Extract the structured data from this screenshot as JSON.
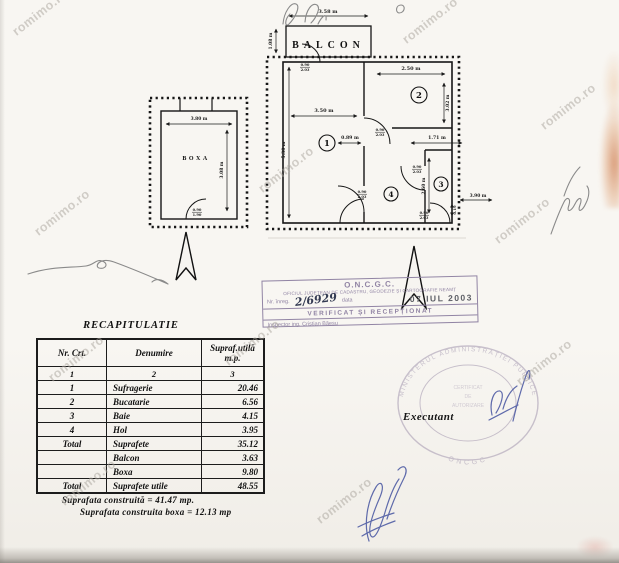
{
  "watermark": {
    "text": "romimo.ro",
    "instances": [
      {
        "x": 14,
        "y": 26,
        "rot": -38
      },
      {
        "x": 404,
        "y": 34,
        "rot": -38
      },
      {
        "x": 542,
        "y": 120,
        "rot": -38
      },
      {
        "x": 36,
        "y": 226,
        "rot": -38
      },
      {
        "x": 260,
        "y": 183,
        "rot": -38
      },
      {
        "x": 496,
        "y": 234,
        "rot": -38
      },
      {
        "x": 50,
        "y": 372,
        "rot": -38
      },
      {
        "x": 226,
        "y": 356,
        "rot": -38
      },
      {
        "x": 518,
        "y": 376,
        "rot": -38
      },
      {
        "x": 62,
        "y": 496,
        "rot": -38
      },
      {
        "x": 318,
        "y": 514,
        "rot": -38
      }
    ]
  },
  "main_plan": {
    "balcony_label": "BALCON",
    "rooms": [
      "1",
      "2",
      "3",
      "4"
    ],
    "dims": {
      "balcony_width": "3.58 m",
      "balcony_depth": "1.08 m",
      "room1_width": "3.50 m",
      "left_height": "5.30 m",
      "seg_a": "0.89 m",
      "seg_b": "1.71 m",
      "room2_width": "2.50 m",
      "room2_height": "3.02 m",
      "bath_height": "2.60 m",
      "right_ext": "3.90 m",
      "right_small": "0.19"
    },
    "door_w": "0.90",
    "door_h": "2.03"
  },
  "boxa_plan": {
    "label": "BOXA",
    "dims": {
      "width": "3.80 m",
      "height": "3.08 m"
    },
    "door_w": "0.90",
    "door_h": "1.90"
  },
  "stamp": {
    "org": "O.N.C.G.C.",
    "office": "OFICIUL JUDEȚEAN DE CADASTRU, GEODEZIE ȘI CARTOGRAFIE NEAMȚ",
    "nr_label": "Nr. înreg.",
    "handwritten_nr": "2/6929",
    "data_label": "data",
    "date": "07 IUL 2003",
    "verified": "VERIFICAT ȘI RECEPȚIONAT",
    "inspector": "Inspector ing. Cristian Băeșu"
  },
  "round_stamp": {
    "ring_text": "MINISTERUL ADMINISTRAȚIEI PUBLICE",
    "bottom_text": "ONCGC",
    "inner_lines": [
      "CERTIFICAT",
      "DE",
      "AUTORIZARE"
    ]
  },
  "executant_label": "Executant",
  "table": {
    "title": "RECAPITULATIE",
    "headers": [
      "Nr. Crt.",
      "Denumire",
      "Supraf.utilă",
      "m.p."
    ],
    "subheader": [
      "1",
      "2",
      "3"
    ],
    "rows": [
      [
        "1",
        "Sufragerie",
        "20.46"
      ],
      [
        "2",
        "Bucatarie",
        "6.56"
      ],
      [
        "3",
        "Baie",
        "4.15"
      ],
      [
        "4",
        "Hol",
        "3.95"
      ],
      [
        "Total",
        "Suprafete",
        "35.12"
      ],
      [
        "",
        "Balcon",
        "3.63"
      ],
      [
        "",
        "Boxa",
        "9.80"
      ],
      [
        "Total",
        "Suprafete utile",
        "48.55"
      ]
    ],
    "notes": [
      "Suprafata construită  =  41.47 mp.",
      "Suprafata construita boxa = 12.13 mp"
    ]
  }
}
